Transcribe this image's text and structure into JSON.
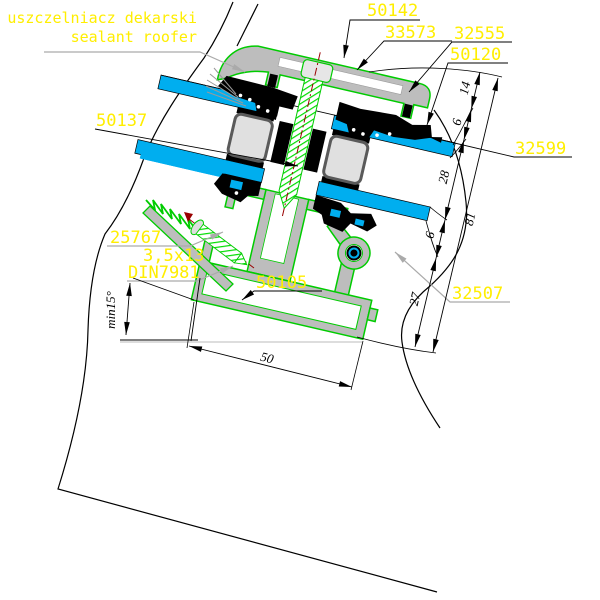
{
  "note": {
    "pl": "uszczelniacz dekarski",
    "en": "sealant roofer"
  },
  "labels": {
    "l50142": "50142",
    "l33573": "33573",
    "l32555": "32555",
    "l50120": "50120",
    "l50137": "50137",
    "l32599": "32599",
    "l25767": "25767",
    "screw_size": "3,5x13",
    "screw_std": "DIN7981",
    "l50105": "50105",
    "l32507": "32507"
  },
  "dims": {
    "d14": "14",
    "d6a": "6",
    "d28": "28",
    "d81": "81",
    "d6b": "6",
    "d27": "27",
    "d50": "50",
    "slope": "min15°"
  },
  "colors": {
    "label_yellow": "#FFEE00",
    "profile_gray": "#BDBDBD",
    "outline_green": "#00CC00",
    "glass_blue": "#00AEEF",
    "screw_green": "#00DD00",
    "centerline_red": "#990000",
    "leader_gray": "#AAAAAA"
  }
}
